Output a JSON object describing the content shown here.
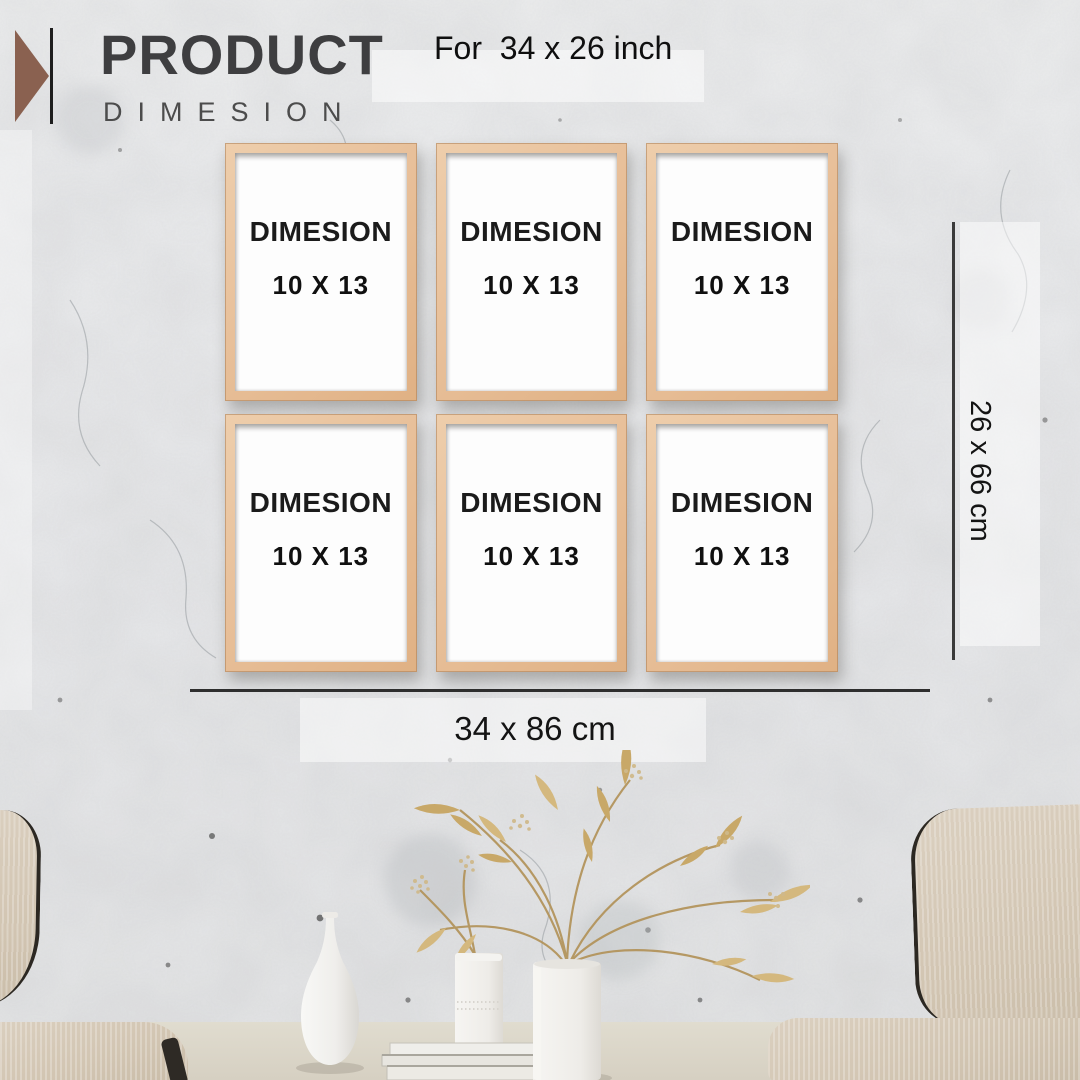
{
  "poster": {
    "brand": {
      "title": "PRODUCT",
      "subtitle": "DIMESION",
      "logo_icon": "triangle-right-icon"
    },
    "top_note": "For  34 x 26 inch",
    "frames": [
      {
        "label": "DIMESION",
        "size": "10 X 13"
      },
      {
        "label": "DIMESION",
        "size": "10 X 13"
      },
      {
        "label": "DIMESION",
        "size": "10 X 13"
      },
      {
        "label": "DIMESION",
        "size": "10 X 13"
      },
      {
        "label": "DIMESION",
        "size": "10 X 13"
      },
      {
        "label": "DIMESION",
        "size": "10 X 13"
      }
    ],
    "dimensions": {
      "vertical": "26 x 66 cm",
      "horizontal": "34 x 86 cm"
    },
    "colors": {
      "frame_wood": "#e8c09a",
      "logo_triangle": "#8a6150",
      "title_text": "#3e3e40",
      "dark_text": "#141414",
      "wall": "#e9eaec",
      "chair_fabric": "#d2c5b2",
      "plant_gold": "#c8a868"
    }
  }
}
